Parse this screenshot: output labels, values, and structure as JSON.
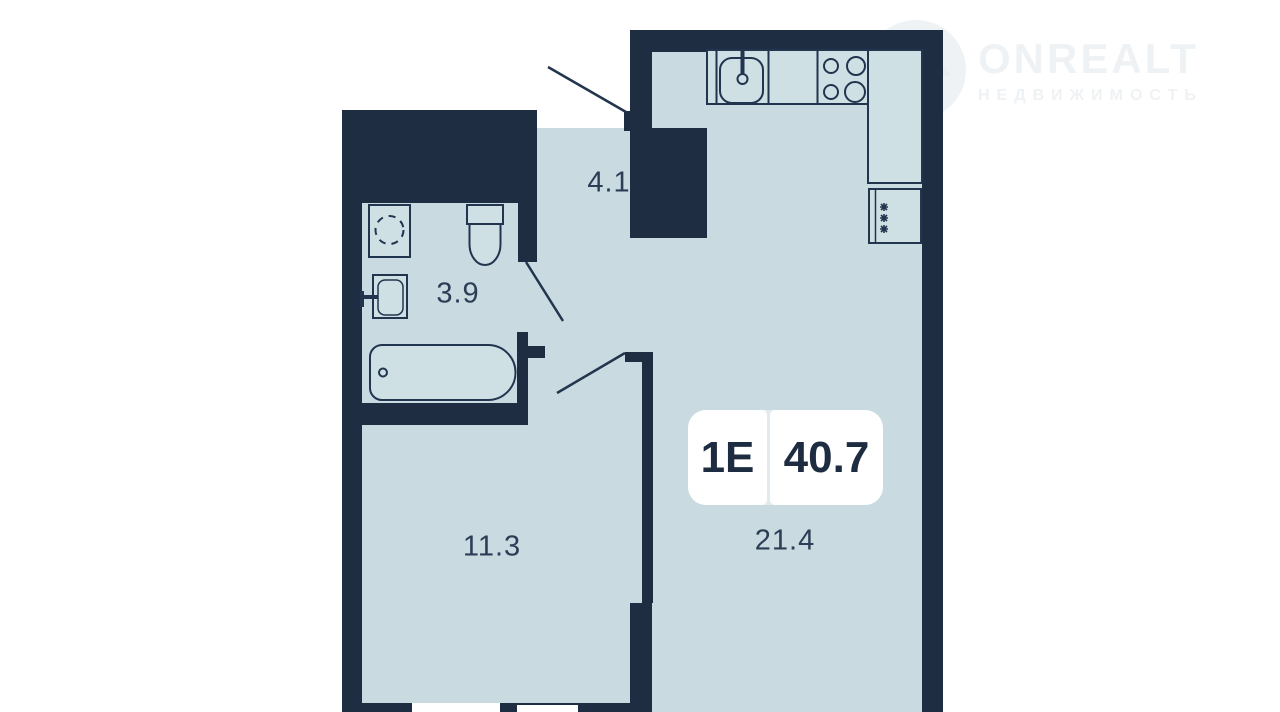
{
  "watermark": {
    "brand": "ONREALT",
    "tagline": "НЕДВИЖИМОСТЬ"
  },
  "plan": {
    "badge": {
      "type": "1E",
      "area": "40.7"
    },
    "rooms": [
      {
        "name": "hallway",
        "area": "4.1"
      },
      {
        "name": "bathroom",
        "area": "3.9"
      },
      {
        "name": "room",
        "area": "11.3"
      },
      {
        "name": "kitchen-living-room",
        "area": "21.4"
      }
    ],
    "fridge_symbol": "✻"
  },
  "colors": {
    "wall": "#1f2d43",
    "floor": "#c9dbe0",
    "fixture_fill": "#cfe0e5",
    "outline": "#22354e",
    "label_text": "#2c3e56",
    "badge_bg": "#ffffff",
    "badge_text": "#1e2c42",
    "watermark": "#eff2f4",
    "watermark_icon": "#e8edf0",
    "background": "#ffffff"
  }
}
